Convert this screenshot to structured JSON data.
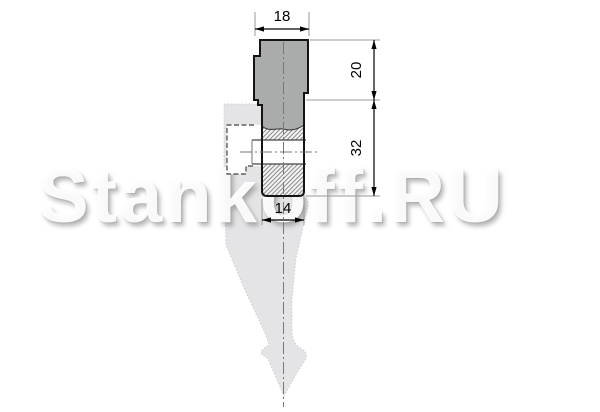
{
  "page": {
    "title": "Press brake punch section drawing",
    "background": "#ffffff"
  },
  "watermark": {
    "text": "Stankoff.RU"
  },
  "drawing": {
    "type": "technical-section",
    "part": "press-brake punch (top tool) cross-section with ghost silhouette",
    "dimensions": [
      {
        "id": "top_width",
        "value": "18",
        "orientation": "horizontal",
        "location": "top"
      },
      {
        "id": "shank_height",
        "value": "20",
        "orientation": "vertical",
        "location": "right"
      },
      {
        "id": "body_height",
        "value": "32",
        "orientation": "vertical",
        "location": "right"
      },
      {
        "id": "bottom_width",
        "value": "14",
        "orientation": "horizontal",
        "location": "bottom"
      }
    ],
    "colors": {
      "shank_fill": "#aaacab",
      "hatch_background": "#f5f5f5",
      "hatch_line": "#777777",
      "outline": "#141414",
      "dimension_line": "#000000",
      "extension_line": "#999999",
      "centerline": "#777777",
      "hidden_line": "#444444",
      "ghost_fill": "#e4e4e6"
    }
  }
}
